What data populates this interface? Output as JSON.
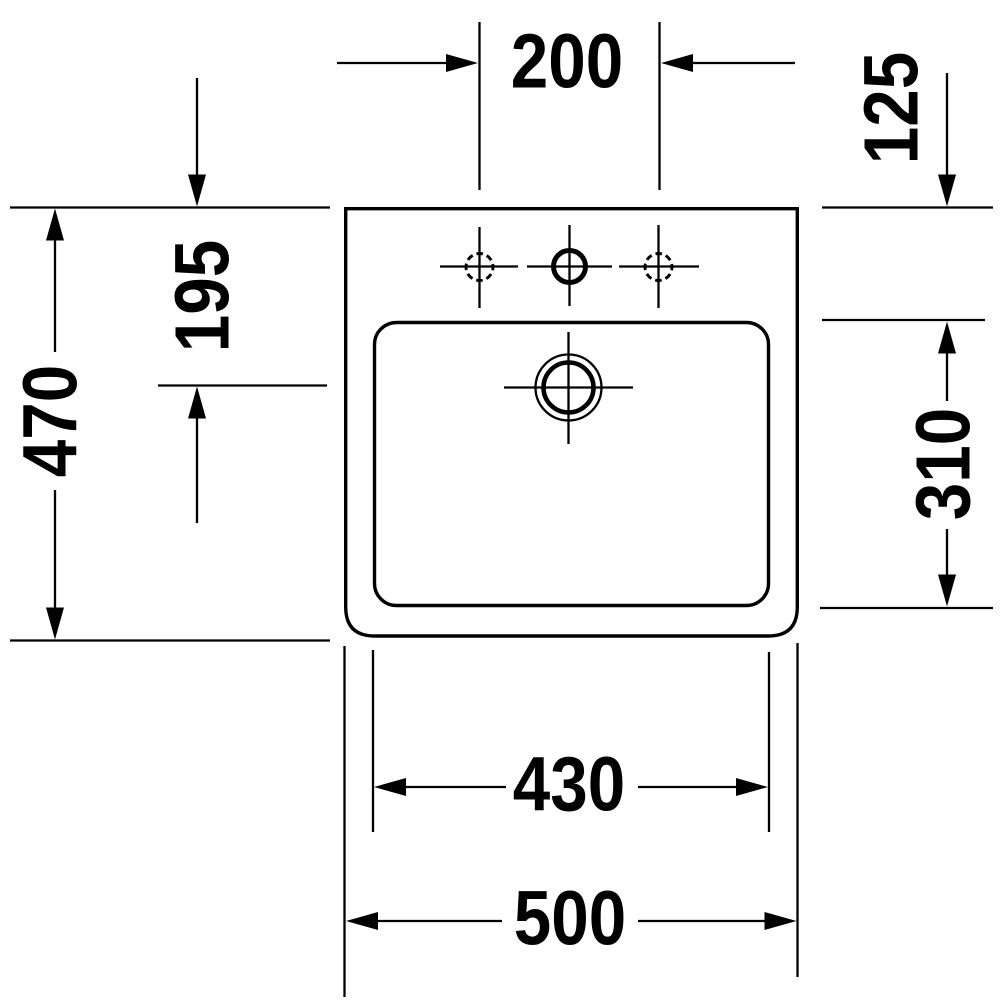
{
  "drawing": {
    "kind": "washbasin-technical-drawing-top-view",
    "background_color": "#ffffff",
    "ink_color": "#000000",
    "labels": {
      "top": "200",
      "right_upper": "125",
      "left_upper": "195",
      "left_outer": "470",
      "right_lower": "310",
      "bottom_inner": "430",
      "bottom_outer": "500"
    }
  }
}
